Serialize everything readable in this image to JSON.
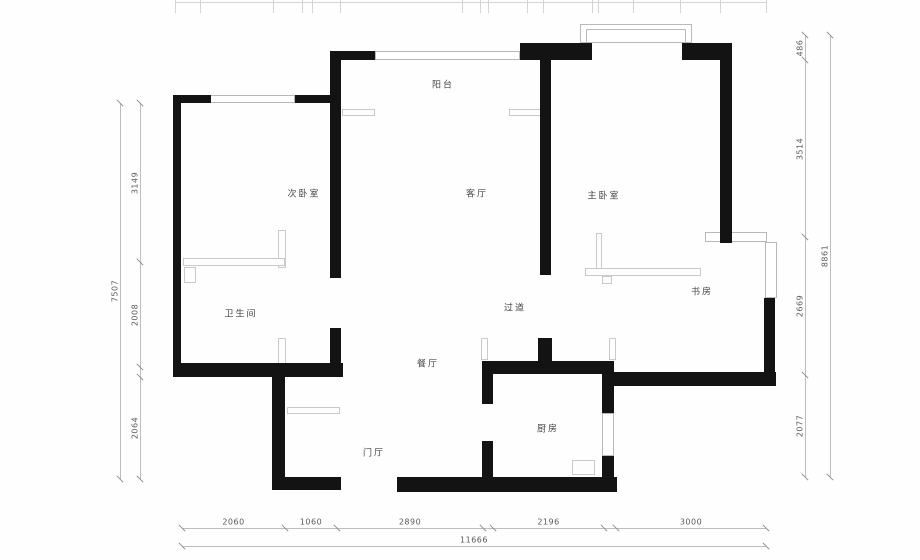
{
  "colors": {
    "wall": "#131313",
    "thin_line": "#c9c9c9",
    "window_line": "#b9b9b9",
    "dim_line": "#bdbdbd",
    "dim_text": "#595959",
    "label_text": "#474747",
    "background": "#fefefe"
  },
  "rooms": [
    {
      "label": "阳台",
      "x": 443,
      "y": 84
    },
    {
      "label": "次卧室",
      "x": 304,
      "y": 193
    },
    {
      "label": "客厅",
      "x": 477,
      "y": 193
    },
    {
      "label": "主卧室",
      "x": 604,
      "y": 195
    },
    {
      "label": "书房",
      "x": 702,
      "y": 291
    },
    {
      "label": "卫生间",
      "x": 241,
      "y": 313
    },
    {
      "label": "过道",
      "x": 515,
      "y": 307
    },
    {
      "label": "餐厅",
      "x": 428,
      "y": 363
    },
    {
      "label": "厨房",
      "x": 548,
      "y": 428
    },
    {
      "label": "门厅",
      "x": 374,
      "y": 452
    }
  ],
  "walls": [
    [
      173,
      95,
      38,
      8
    ],
    [
      295,
      95,
      46,
      8
    ],
    [
      173,
      95,
      8,
      282
    ],
    [
      173,
      363,
      170,
      14
    ],
    [
      330,
      51,
      11,
      227
    ],
    [
      330,
      328,
      11,
      49
    ],
    [
      330,
      51,
      45,
      9
    ],
    [
      520,
      43,
      72,
      17
    ],
    [
      682,
      43,
      50,
      17
    ],
    [
      540,
      52,
      11,
      223
    ],
    [
      720,
      58,
      12,
      185
    ],
    [
      764,
      298,
      11,
      88
    ],
    [
      610,
      372,
      166,
      14
    ],
    [
      482,
      361,
      132,
      13
    ],
    [
      538,
      338,
      14,
      23
    ],
    [
      482,
      374,
      11,
      30
    ],
    [
      482,
      441,
      11,
      39
    ],
    [
      397,
      477,
      220,
      15
    ],
    [
      602,
      368,
      12,
      45
    ],
    [
      602,
      456,
      12,
      36
    ],
    [
      272,
      377,
      13,
      113
    ],
    [
      272,
      477,
      69,
      13
    ]
  ],
  "windows": [
    [
      210,
      95,
      85,
      8
    ],
    [
      375,
      51,
      145,
      9
    ],
    [
      580,
      24,
      112,
      19
    ],
    [
      586,
      29,
      100,
      14
    ],
    [
      602,
      413,
      12,
      43
    ],
    [
      765,
      242,
      12,
      56
    ],
    [
      705,
      232,
      62,
      10
    ]
  ],
  "furniture": [
    [
      278,
      230,
      8,
      38
    ],
    [
      183,
      258,
      102,
      8
    ],
    [
      184,
      267,
      12,
      16
    ],
    [
      596,
      233,
      6,
      36
    ],
    [
      585,
      268,
      116,
      8
    ],
    [
      602,
      276,
      10,
      8
    ],
    [
      342,
      109,
      33,
      7
    ],
    [
      509,
      109,
      33,
      7
    ],
    [
      287,
      407,
      53,
      7
    ],
    [
      572,
      460,
      23,
      15
    ],
    [
      481,
      338,
      7,
      22
    ],
    [
      609,
      338,
      7,
      22
    ],
    [
      278,
      338,
      8,
      39
    ]
  ],
  "dimensions": {
    "vertical": [
      {
        "x": 140,
        "segments": [
          {
            "label": "3149",
            "from": 103,
            "to": 262
          },
          {
            "label": "2008",
            "from": 262,
            "to": 367
          },
          {
            "label": "",
            "from": 367,
            "to": 377
          },
          {
            "label": "2064",
            "from": 377,
            "to": 479
          }
        ]
      },
      {
        "x": 120,
        "segments": [
          {
            "label": "7507",
            "from": 103,
            "to": 479
          }
        ]
      },
      {
        "x": 805,
        "segments": [
          {
            "label": "486",
            "from": 35,
            "to": 60
          },
          {
            "label": "3514",
            "from": 60,
            "to": 237
          },
          {
            "label": "2669",
            "from": 237,
            "to": 375
          },
          {
            "label": "2077",
            "from": 375,
            "to": 477
          }
        ]
      },
      {
        "x": 830,
        "segments": [
          {
            "label": "8861",
            "from": 35,
            "to": 477
          }
        ]
      }
    ],
    "horizontal": [
      {
        "y": 528,
        "segments": [
          {
            "label": "2060",
            "from": 182,
            "to": 285
          },
          {
            "label": "1060",
            "from": 285,
            "to": 337
          },
          {
            "label": "2890",
            "from": 337,
            "to": 483
          },
          {
            "label": "",
            "from": 483,
            "to": 493
          },
          {
            "label": "2196",
            "from": 493,
            "to": 604
          },
          {
            "label": "",
            "from": 604,
            "to": 616
          },
          {
            "label": "3000",
            "from": 616,
            "to": 766
          }
        ]
      },
      {
        "y": 546,
        "segments": [
          {
            "label": "11666",
            "from": 182,
            "to": 766
          }
        ]
      }
    ],
    "top_ruler": {
      "y": 2,
      "from": 175,
      "to": 766,
      "tick_length": 13,
      "ticks": [
        175,
        200,
        273,
        302,
        312,
        340,
        462,
        480,
        488,
        527,
        543,
        592,
        598,
        633,
        680,
        720,
        766
      ]
    }
  }
}
